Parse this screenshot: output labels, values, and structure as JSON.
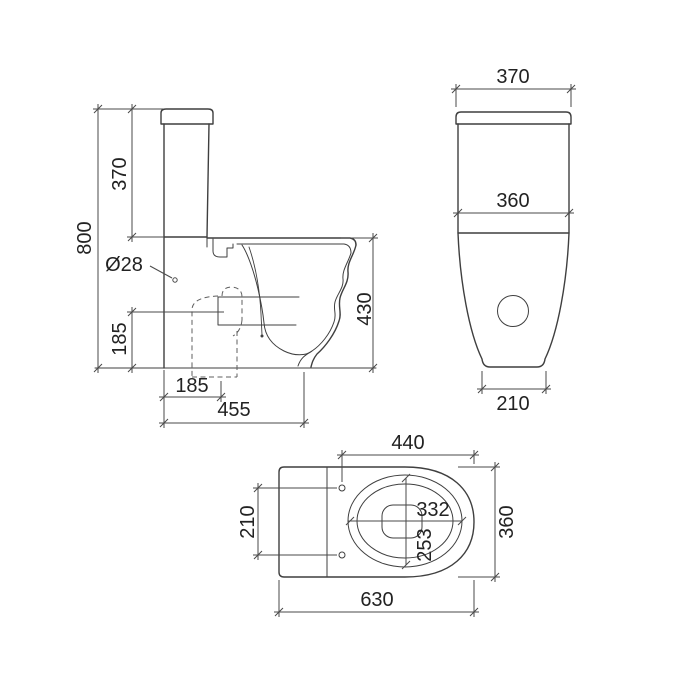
{
  "drawing": {
    "background": "#ffffff",
    "line_color": "#3f3f3f",
    "dimension_color": "#4a4a4a",
    "text_color": "#222222",
    "views": {
      "side": {
        "dims": {
          "total_height": "800",
          "cistern_height": "370",
          "inlet_hole_diameter": "Ø28",
          "outlet_centre_height": "185",
          "outlet_centre_setout": "185",
          "base_depth": "455",
          "pan_height": "430"
        }
      },
      "front": {
        "dims": {
          "lid_width": "370",
          "tank_width": "360",
          "base_width": "210"
        }
      },
      "top": {
        "dims": {
          "rim_length": "440",
          "overall_width": "360",
          "fixing_hole_centres": "210",
          "inner_bowl_length": "332",
          "inner_bowl_width": "253",
          "overall_length": "630"
        }
      }
    }
  }
}
